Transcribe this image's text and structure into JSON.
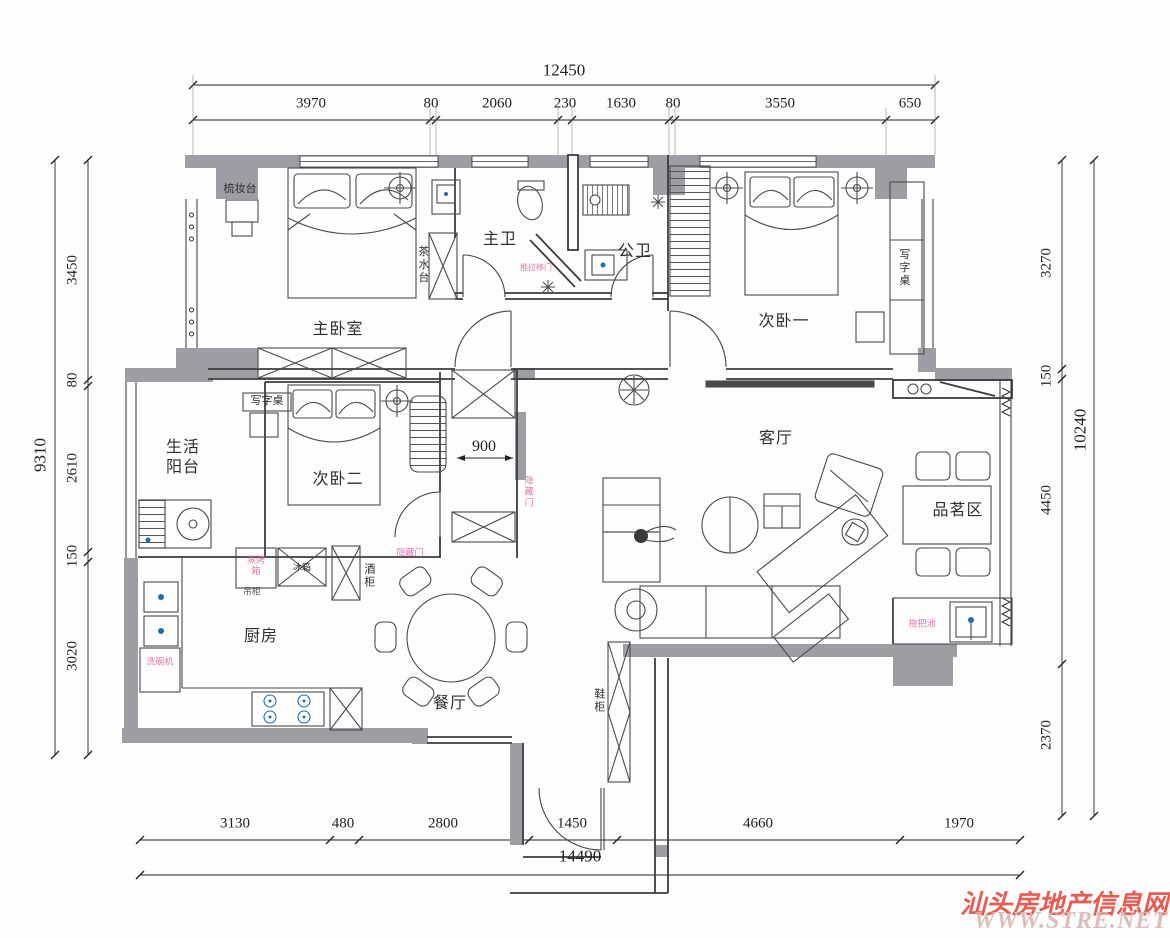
{
  "dimensions": {
    "top": {
      "total": "12450",
      "segments": [
        "3970",
        "80",
        "2060",
        "230",
        "1630",
        "80",
        "3550",
        "650"
      ]
    },
    "bottom": {
      "total": "14490",
      "segments": [
        "3130",
        "480",
        "2800",
        "1450",
        "4660",
        "1970"
      ]
    },
    "left": {
      "total": "9310",
      "segments": [
        "3450",
        "80",
        "2610",
        "150",
        "3020"
      ]
    },
    "right": {
      "total": "10240",
      "segments": [
        "3270",
        "150",
        "4450",
        "2370"
      ]
    },
    "corridor_width": "900"
  },
  "rooms": {
    "master_bedroom": "主卧室",
    "bedroom_one": "次卧一",
    "bedroom_two": "次卧二",
    "master_bath": "主卫",
    "public_bath": "公卫",
    "living_room": "客厅",
    "dining_room": "餐厅",
    "kitchen": "厨房",
    "balcony": "生活阳台",
    "tea_area": "品茗区"
  },
  "annotations": {
    "dressing_table": "梳妆台",
    "tea_station": "茶水台",
    "desk_bedroom1": "写字桌",
    "desk_bedroom2": "写字桌",
    "fridge": "冰箱",
    "wine_cabinet": "酒柜",
    "shoe_cabinet": "鞋柜",
    "hanging_cabinet": "吊柜",
    "steam_oven": "蒸烤箱",
    "dishwasher": "洗碗机",
    "mop_sink": "拖把池",
    "hidden_door": "隐藏门",
    "sliding_door": "推拉移门"
  },
  "watermark": {
    "site_name": "汕头房地产信息网",
    "site_url": "WWW.STRE.NET",
    "color": "#e6453a"
  }
}
